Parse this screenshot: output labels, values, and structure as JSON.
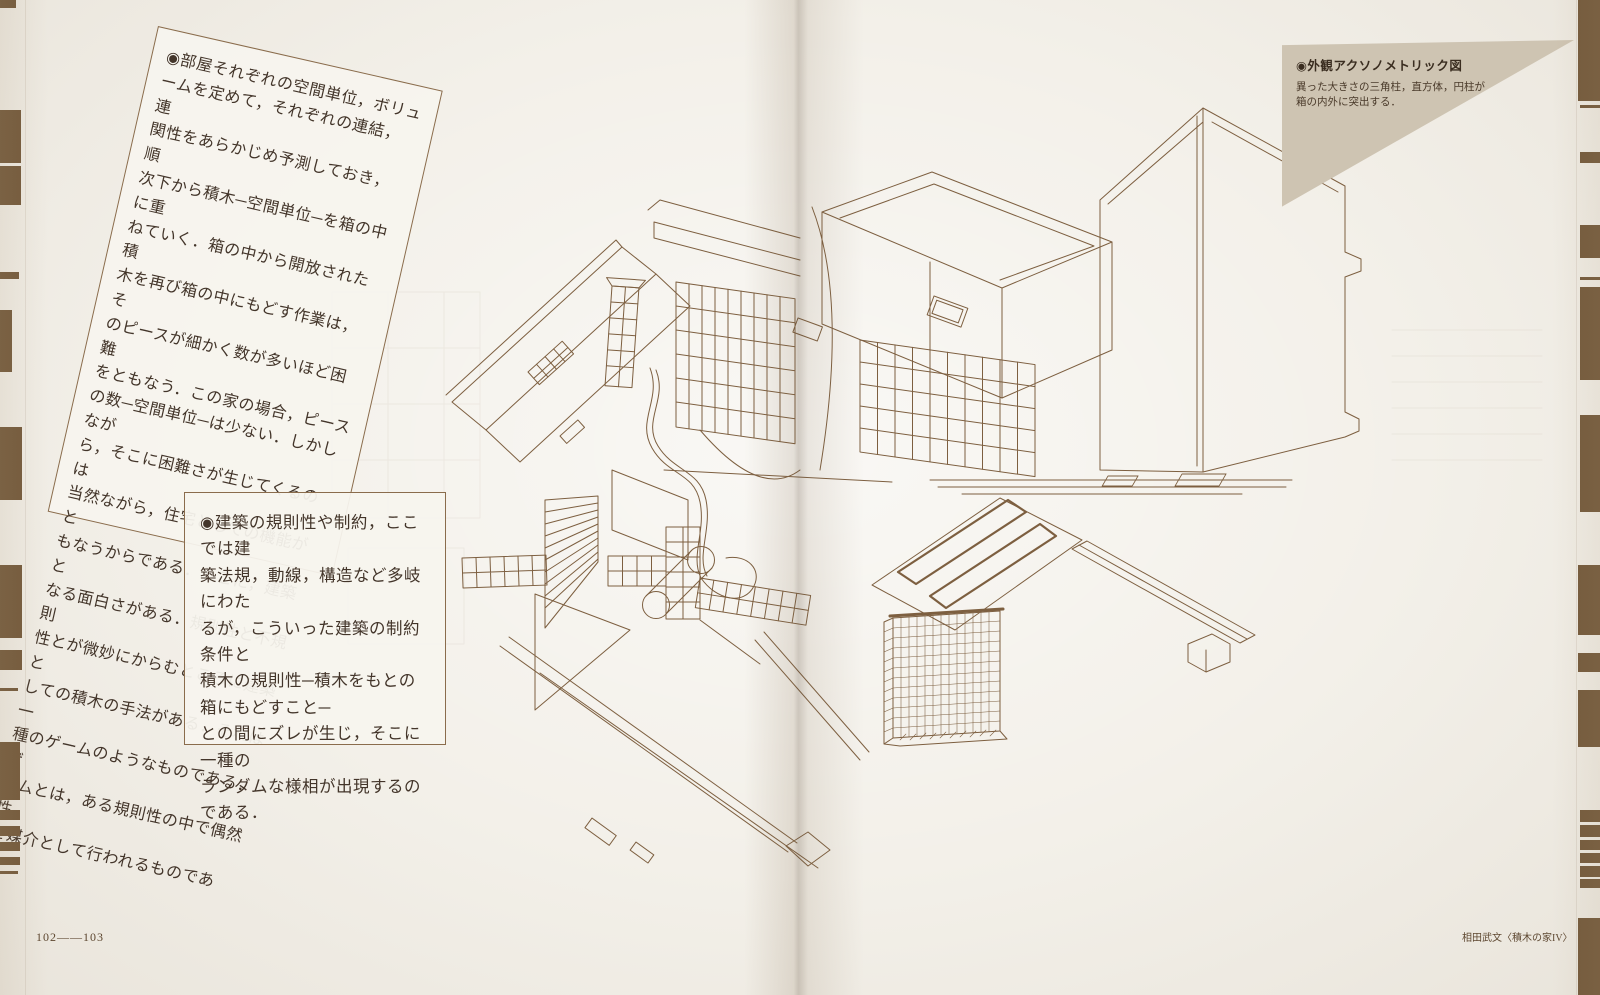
{
  "palette": {
    "paper": "#f3f0e9",
    "text": "#43352a",
    "line": "#7d5f40",
    "border": "#8a6c4c",
    "edge": "#73593b",
    "tan": "#cec4b2",
    "footerInk": "#5d4730"
  },
  "notes": {
    "rotated": "◉部屋それぞれの空間単位，ボリュ\nームを定めて，それぞれの連結，連\n関性をあらかじめ予測しておき，順\n次下から積木─空間単位─を箱の中に重\nねていく．箱の中から開放された積\n木を再び箱の中にもどす作業は，そ\nのピースが細かく数が多いほど困難\nをともなう．この家の場合，ピース\nの数─空間単位─は少ない．しかしなが\nら，そこに困難さが生じてくるのは\n当然ながら，住宅としての機能がと\nもなうからである．そこに，建築と\nなる面白さがある．規則性と不規則\n性とが微妙にからむところに建築と\nしての積木の手法がある．それは一\n種のゲームのようなものである．ゲ\nームとは，ある規則性の中で偶然性\nを媒介として行われるものである．",
    "boxed": "◉建築の規則性や制約，ここでは建\n築法規，動線，構造など多岐にわた\nるが，こういった建築の制約条件と\n積木の規則性─積木をもとの箱にもどすこと─\nとの間にズレが生じ，そこに一種の\nランダムな様相が出現するのである．"
  },
  "caption": {
    "title": "◉外観アクソノメトリック図",
    "body": "異った大きさの三角柱，直方体，円柱が\n箱の内外に突出する．"
  },
  "footer": {
    "pages": "102——103",
    "credit": "相田武文〈積木の家IV〉"
  }
}
